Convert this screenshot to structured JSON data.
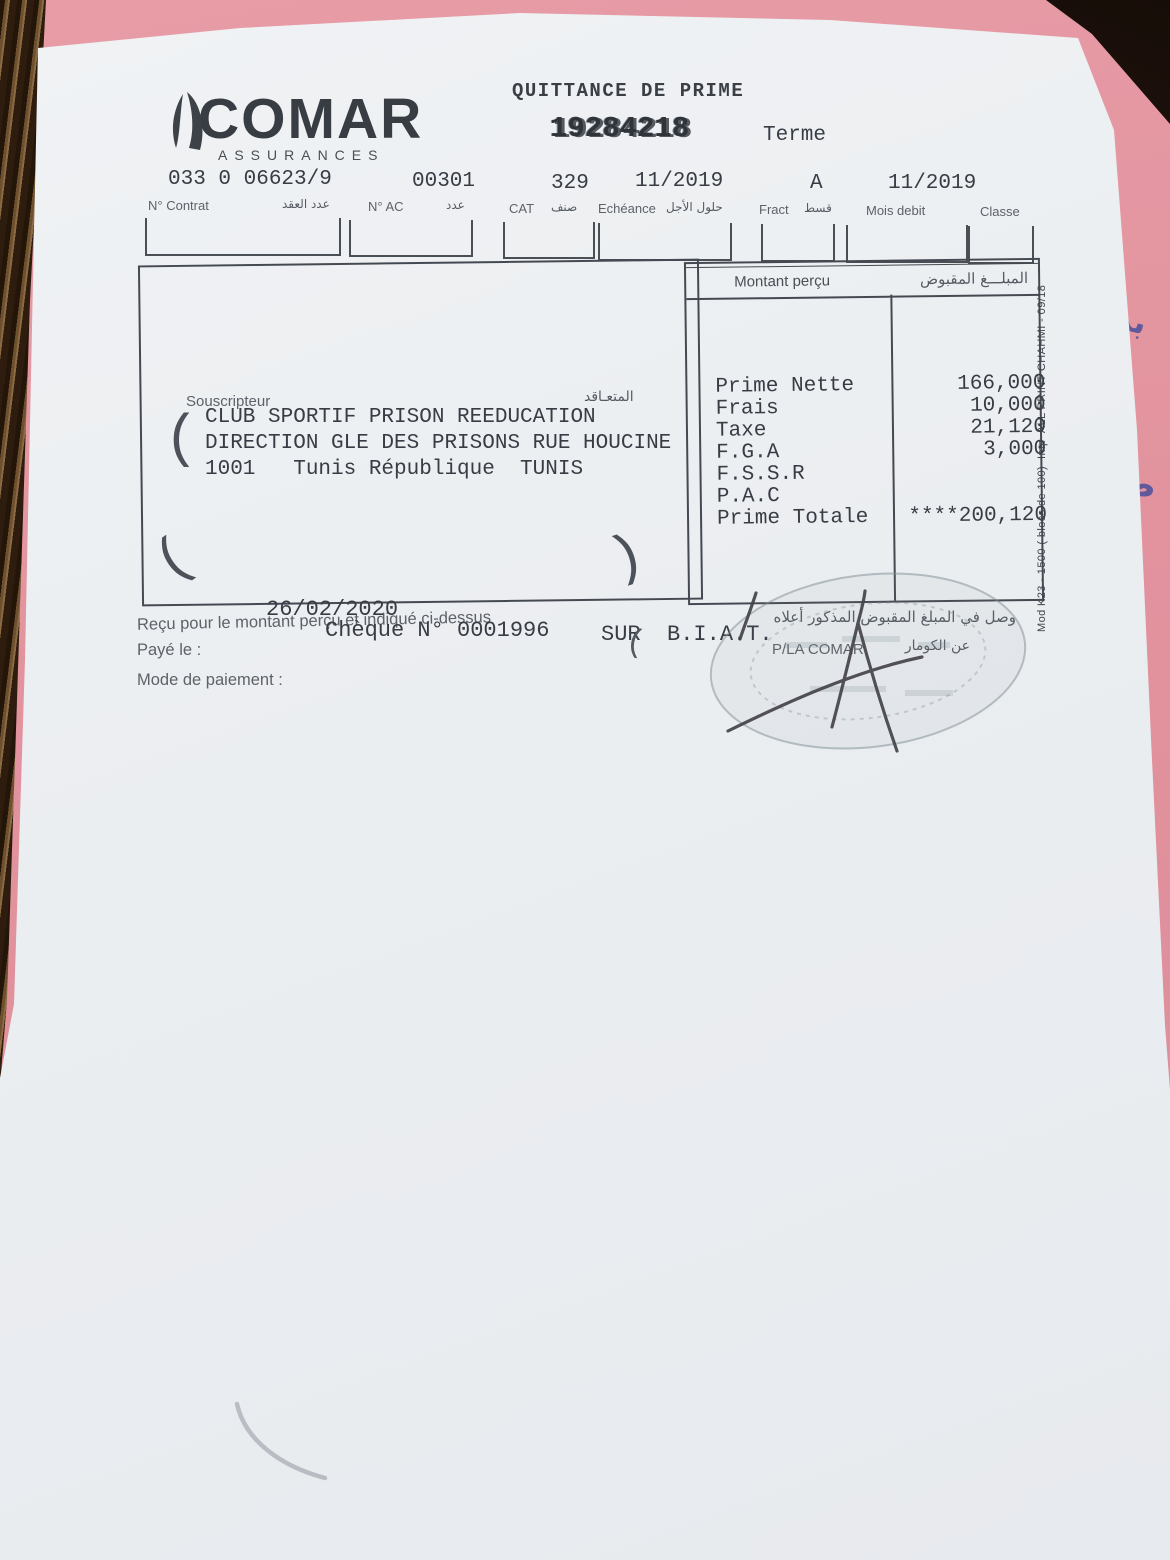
{
  "brand": {
    "name": "COMAR",
    "subtitle": "ASSURANCES"
  },
  "header": {
    "title": "QUITTANCE DE PRIME",
    "receipt_number": "19284218",
    "term_label": "Terme"
  },
  "fields": [
    {
      "value": "033 0 06623/9",
      "label": "N° Contrat",
      "label_ar": "عدد العقد"
    },
    {
      "value": "00301",
      "label": "N° AC",
      "label_ar": "عدد"
    },
    {
      "value": "329",
      "label": "CAT",
      "label_ar": "صنف"
    },
    {
      "value": "11/2019",
      "label": "Echéance",
      "label_ar": "حلول الأجل"
    },
    {
      "value": "A",
      "label": "Fract",
      "label_ar": "قسط"
    },
    {
      "value": "11/2019",
      "label": "Mois debit",
      "label_ar": ""
    },
    {
      "value": "",
      "label": "Classe",
      "label_ar": ""
    }
  ],
  "souscripteur": {
    "label": "Souscripteur",
    "label_ar": "المتعـاقد",
    "lines": [
      "CLUB SPORTIF PRISON REEDUCATION",
      "DIRECTION GLE DES PRISONS RUE HOUCINE",
      "1001   Tunis République  TUNIS"
    ]
  },
  "montant": {
    "header": "Montant perçu",
    "header_ar": "المبلـــغ المقبوض",
    "rows": [
      {
        "label": "Prime Nette",
        "amount": "166,000"
      },
      {
        "label": "Frais",
        "amount": "10,000"
      },
      {
        "label": "Taxe",
        "amount": "21,120"
      },
      {
        "label": "F.G.A",
        "amount": "3,000"
      },
      {
        "label": "F.S.S.R",
        "amount": ""
      },
      {
        "label": "P.A.C",
        "amount": ""
      },
      {
        "label": "Prime Totale",
        "amount": "****200,120"
      }
    ]
  },
  "footer": {
    "receipt_statement": "Reçu pour le montant perçu et indiqué ci-dessus",
    "receipt_statement_ar": "وصل في المبلغ المقبوض المذكور أعلاه",
    "paye_label": "Payé le :",
    "paye_date": "26/02/2020",
    "mode_label": "Mode de paiement :",
    "cheque_line": "Chèque N° 0001996",
    "sur_line": "SUR  B.I.A.T.",
    "pla_comar": "P/LA COMAR",
    "pla_comar_ar": "عن الكومار"
  },
  "print_ref_vertical": "Mod K23 - 1500 ( blocs de 100)  Imp  ALL PRINT CHAHMI - 09/18",
  "handwriting_notes": [
    "بن",
    "ط ا"
  ],
  "colors": {
    "backing_pink": "#e59aa2",
    "paper": "#eef0f2",
    "typed_ink": "#383d45",
    "printed_ink": "#5d6269",
    "pen_ink": "#45434b"
  }
}
